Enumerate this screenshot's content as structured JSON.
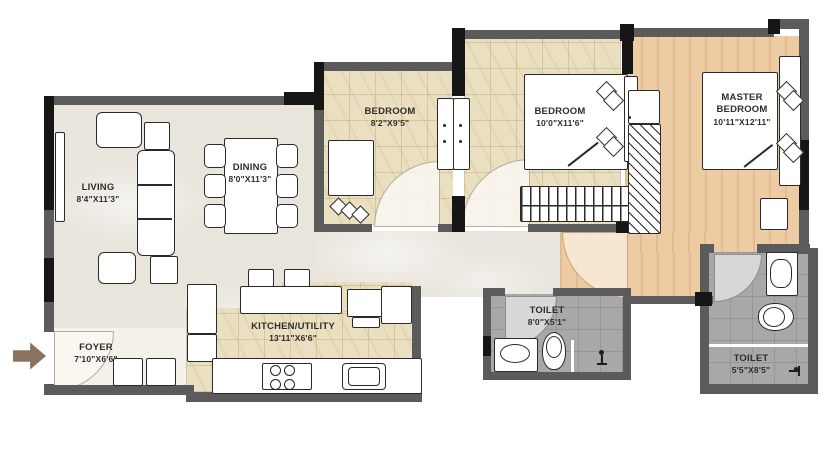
{
  "plan_title": "2BHK-style apartment floor plan",
  "rooms": {
    "living": {
      "label": "LIVING",
      "dims": "8'4\"X11'3\""
    },
    "dining": {
      "label": "DINING",
      "dims": "8'0\"X11'3\""
    },
    "foyer": {
      "label": "FOYER",
      "dims": "7'10\"X6'6\""
    },
    "kitchen": {
      "label": "KITCHEN/UTILITY",
      "dims": "13'11\"X6'6\""
    },
    "bedroom1": {
      "label": "BEDROOM",
      "dims": "8'2\"X9'5\""
    },
    "bedroom2": {
      "label": "BEDROOM",
      "dims": "10'0\"X11'6\""
    },
    "master": {
      "label": "MASTER BEDROOM",
      "dims": "10'11\"X12'11\""
    },
    "toilet1": {
      "label": "TOILET",
      "dims": "8'0\"X5'1\""
    },
    "toilet2": {
      "label": "TOILET",
      "dims": "5'5\"X8'5\""
    }
  },
  "icons": {
    "entry_arrow": "right-arrow entry marker",
    "shower": "shower/floor-drain symbol",
    "stove": "4-burner hob",
    "sink": "kitchen sink",
    "wc": "water closet",
    "basin": "wash basin"
  },
  "colors": {
    "wall": "#5b5b5b",
    "wall_dark": "#161616",
    "floor_living": "#e9e5dc",
    "floor_foyer": "#f4f1ea",
    "floor_tile": "#ebdfc1",
    "floor_wood": "#edcba3",
    "floor_toilet": "#a8a8a8",
    "entry_arrow": "#8a7360"
  }
}
